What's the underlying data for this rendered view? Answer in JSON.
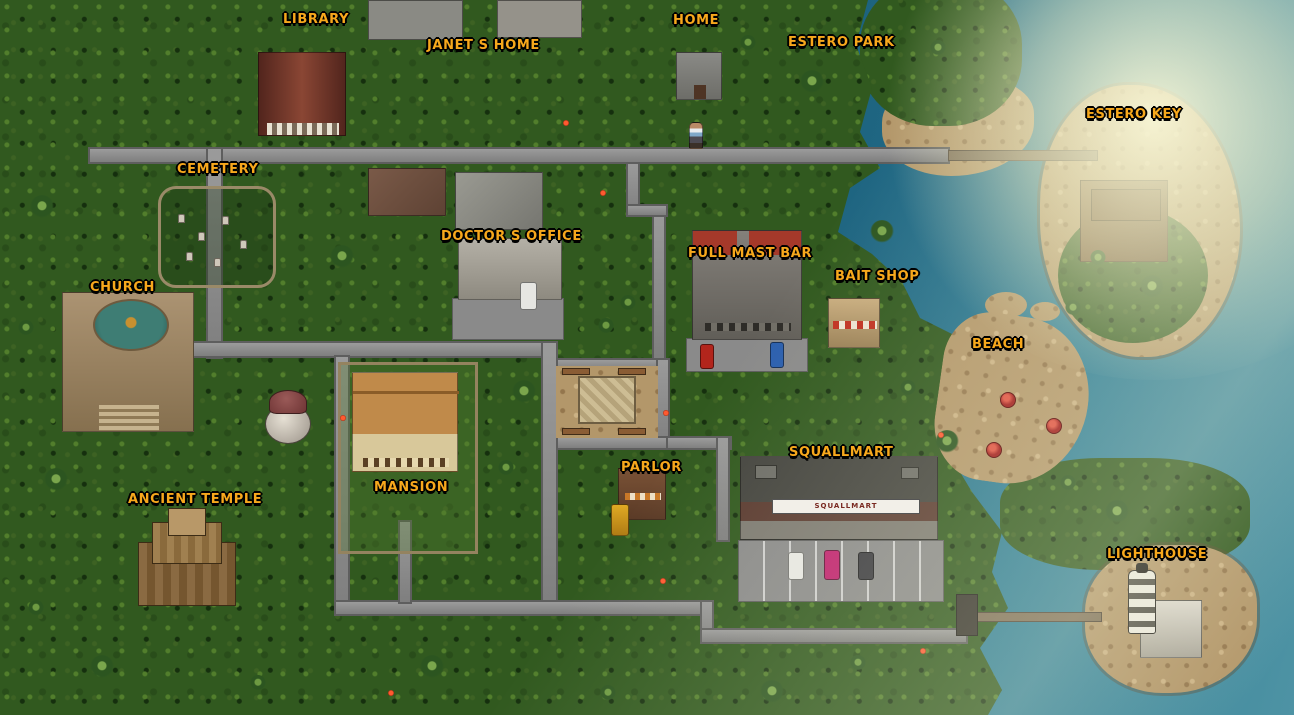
{
  "locations": [
    {
      "id": "library",
      "label": "LIBRARY"
    },
    {
      "id": "janets-home",
      "label": "JANET S HOME"
    },
    {
      "id": "home",
      "label": "HOME"
    },
    {
      "id": "estero-park",
      "label": "ESTERO PARK"
    },
    {
      "id": "estero-key",
      "label": "ESTERO KEY"
    },
    {
      "id": "cemetery",
      "label": "CEMETERY"
    },
    {
      "id": "doctors-office",
      "label": "DOCTOR S OFFICE"
    },
    {
      "id": "full-mast-bar",
      "label": "FULL MAST BAR"
    },
    {
      "id": "bait-shop",
      "label": "BAIT SHOP"
    },
    {
      "id": "church",
      "label": "CHURCH"
    },
    {
      "id": "beach",
      "label": "BEACH"
    },
    {
      "id": "mansion",
      "label": "MANSION"
    },
    {
      "id": "parlor",
      "label": "PARLOR"
    },
    {
      "id": "squallmart",
      "label": "SQUALLMART"
    },
    {
      "id": "ancient-temple",
      "label": "ANCIENT TEMPLE"
    },
    {
      "id": "lighthouse",
      "label": "LIGHTHOUSE"
    }
  ],
  "signs": {
    "squallmart_storefront": "SQUALLMART"
  },
  "colors": {
    "ocean_deep": "#14556f",
    "ocean_shallow": "#2e7e96",
    "sun_glare": "#faf8d7",
    "land_green": "#31591f",
    "sand": "#b3976a",
    "road": "#8d8d8d",
    "label_gold": "#f7a81c"
  }
}
